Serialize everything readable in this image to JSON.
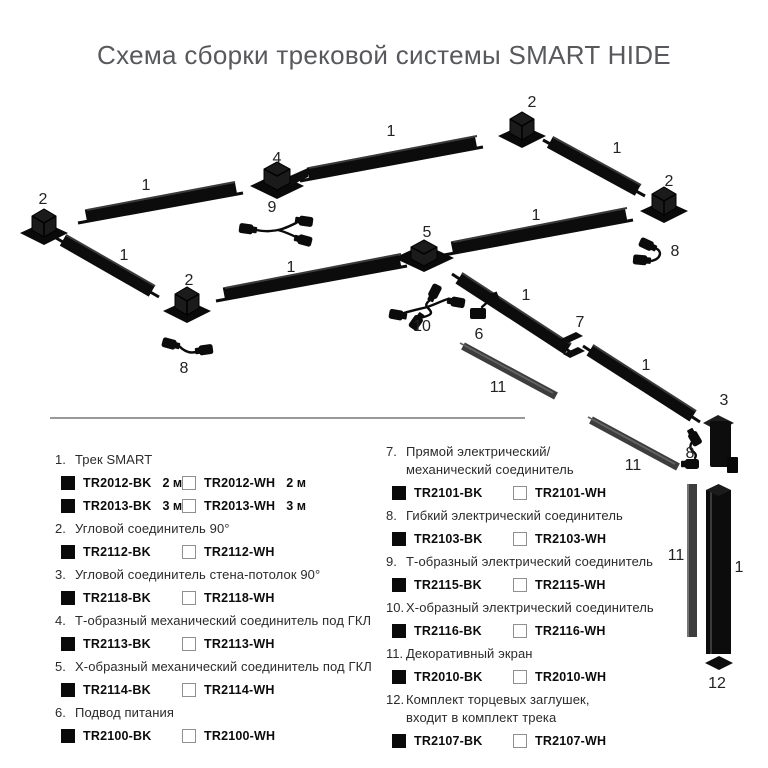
{
  "title": "Схема сборки трековой системы SMART HIDE",
  "colors": {
    "track_black": "#0c0c0c",
    "screen_gray": "#3d3d3d",
    "title_gray": "#58595c",
    "divider_gray": "#98999b",
    "checkbox_border_gray": "#8f8f8f",
    "label_dark": "#222222"
  },
  "diagram": {
    "labels": [
      {
        "text": "2",
        "x": 43,
        "y": 204
      },
      {
        "text": "1",
        "x": 146,
        "y": 190
      },
      {
        "text": "4",
        "x": 277,
        "y": 163
      },
      {
        "text": "9",
        "x": 272,
        "y": 212
      },
      {
        "text": "1",
        "x": 391,
        "y": 136
      },
      {
        "text": "2",
        "x": 532,
        "y": 107
      },
      {
        "text": "1",
        "x": 617,
        "y": 153
      },
      {
        "text": "2",
        "x": 669,
        "y": 186
      },
      {
        "text": "8",
        "x": 675,
        "y": 256
      },
      {
        "text": "5",
        "x": 427,
        "y": 237
      },
      {
        "text": "1",
        "x": 536,
        "y": 220
      },
      {
        "text": "1",
        "x": 124,
        "y": 260
      },
      {
        "text": "2",
        "x": 189,
        "y": 285
      },
      {
        "text": "1",
        "x": 291,
        "y": 272
      },
      {
        "text": "8",
        "x": 184,
        "y": 373
      },
      {
        "text": "10",
        "x": 422,
        "y": 331
      },
      {
        "text": "6",
        "x": 479,
        "y": 339
      },
      {
        "text": "1",
        "x": 526,
        "y": 300
      },
      {
        "text": "7",
        "x": 580,
        "y": 327
      },
      {
        "text": "11",
        "x": 498,
        "y": 392
      },
      {
        "text": "1",
        "x": 646,
        "y": 370
      },
      {
        "text": "3",
        "x": 724,
        "y": 405
      },
      {
        "text": "8",
        "x": 690,
        "y": 458
      },
      {
        "text": "11",
        "x": 633,
        "y": 470
      },
      {
        "text": "11",
        "x": 676,
        "y": 560
      },
      {
        "text": "1",
        "x": 739,
        "y": 572
      },
      {
        "text": "12",
        "x": 717,
        "y": 688
      }
    ]
  },
  "legend": {
    "columns": [
      {
        "side": "left",
        "items": [
          {
            "num": "1.",
            "name": "Трек SMART",
            "rows": [
              {
                "bk": "TR2012-BK",
                "bk_extra": "2 м",
                "wh": "TR2012-WH",
                "wh_extra": "2 м"
              },
              {
                "bk": "TR2013-BK",
                "bk_extra": "3 м",
                "wh": "TR2013-WH",
                "wh_extra": "3 м"
              }
            ]
          },
          {
            "num": "2.",
            "name": "Угловой соединитель 90°",
            "rows": [
              {
                "bk": "TR2112-BK",
                "wh": "TR2112-WH"
              }
            ]
          },
          {
            "num": "3.",
            "name": "Угловой соединитель стена-потолок 90°",
            "rows": [
              {
                "bk": "TR2118-BK",
                "wh": "TR2118-WH"
              }
            ]
          },
          {
            "num": "4.",
            "name": "Т-образный механический соединитель под ГКЛ",
            "rows": [
              {
                "bk": "TR2113-BK",
                "wh": "TR2113-WH"
              }
            ]
          },
          {
            "num": "5.",
            "name": "Х-образный механический соединитель под ГКЛ",
            "rows": [
              {
                "bk": "TR2114-BK",
                "wh": "TR2114-WH"
              }
            ]
          },
          {
            "num": "6.",
            "name": "Подвод питания",
            "rows": [
              {
                "bk": "TR2100-BK",
                "wh": "TR2100-WH"
              }
            ]
          }
        ]
      },
      {
        "side": "right",
        "items": [
          {
            "num": "7.",
            "name": "Прямой электрический/\nмеханический соединитель",
            "rows": [
              {
                "bk": "TR2101-BK",
                "wh": "TR2101-WH"
              }
            ]
          },
          {
            "num": "8.",
            "name": "Гибкий электрический соединитель",
            "rows": [
              {
                "bk": "TR2103-BK",
                "wh": "TR2103-WH"
              }
            ]
          },
          {
            "num": "9.",
            "name": "Т-образный электрический соединитель",
            "rows": [
              {
                "bk": "TR2115-BK",
                "wh": "TR2115-WH"
              }
            ]
          },
          {
            "num": "10.",
            "name": "Х-образный электрический соединитель",
            "rows": [
              {
                "bk": "TR2116-BK",
                "wh": "TR2116-WH"
              }
            ]
          },
          {
            "num": "11.",
            "name": "Декоративный экран",
            "rows": [
              {
                "bk": "TR2010-BK",
                "wh": "TR2010-WH"
              }
            ]
          },
          {
            "num": "12.",
            "name": "Комплект торцевых заглушек,\nвходит в комплект трека",
            "rows": [
              {
                "bk": "TR2107-BK",
                "wh": "TR2107-WH"
              }
            ]
          }
        ]
      }
    ]
  }
}
